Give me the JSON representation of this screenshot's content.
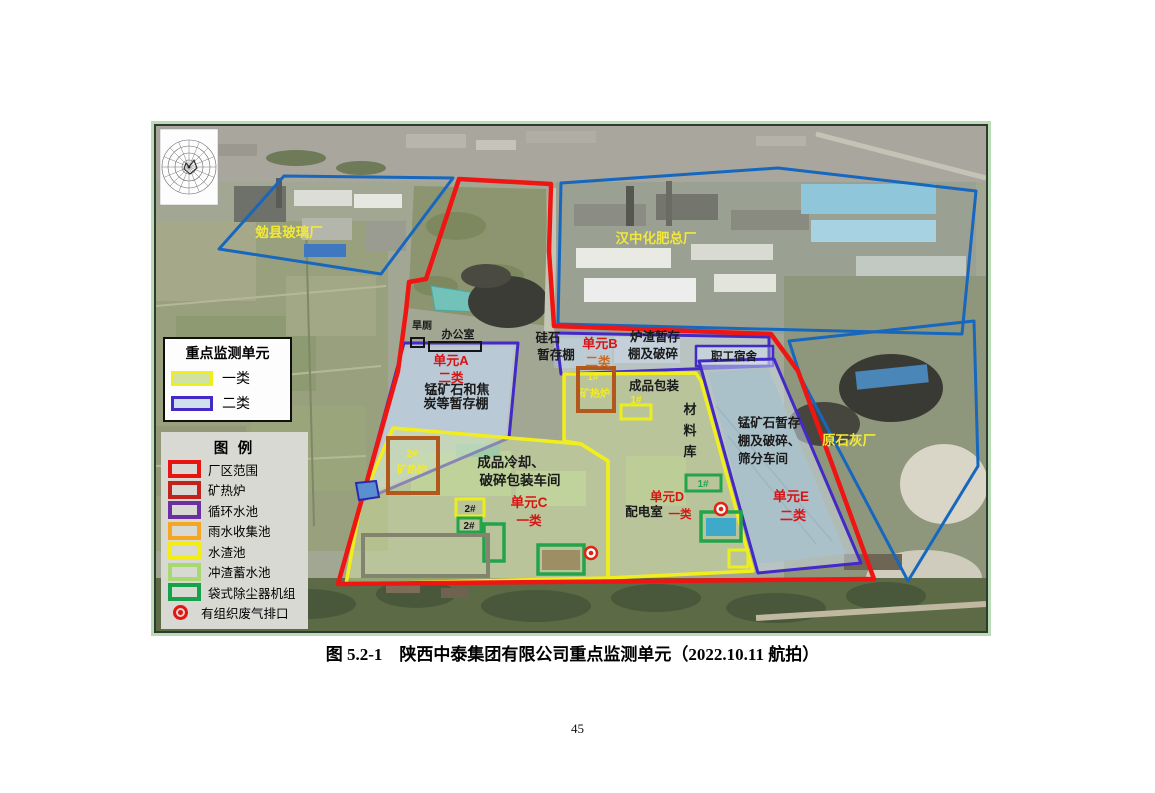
{
  "page": {
    "number": "45"
  },
  "figure_caption": "图 5.2-1　陕西中泰集团有限公司重点监测单元（2022.10.11 航拍）",
  "monitor_legend": {
    "title": "重点监测单元",
    "items": [
      {
        "label": "一类",
        "fill": "#cfe2a0",
        "border": "#f2ee1d"
      },
      {
        "label": "二类",
        "fill": "#cfdfee",
        "border": "#4329c6"
      }
    ]
  },
  "map_legend": {
    "title": "图 例",
    "items": [
      {
        "label": "厂区范围",
        "color": "#e6150f"
      },
      {
        "label": "矿热炉",
        "color": "#c2221c"
      },
      {
        "label": "循环水池",
        "color": "#6b2fa2"
      },
      {
        "label": "雨水收集池",
        "color": "#f5a623"
      },
      {
        "label": "水渣池",
        "color": "#f3ec15"
      },
      {
        "label": "冲渣蓄水池",
        "color": "#a7d96e"
      },
      {
        "label": "袋式除尘器机组",
        "color": "#16a14b"
      },
      {
        "label": "有组织废气排口",
        "color": "#e6150f"
      }
    ]
  },
  "photo_labels": {
    "glass_factory": "勉县玻璃厂",
    "fertilizer_factory": "汉中化肥总厂",
    "lime_factory": "原石灰厂",
    "dry_toilet": "旱厕",
    "office": "办公室",
    "unit_a": "单元A",
    "unit_a_class": "二类",
    "shed_a_line1": "锰矿石和焦",
    "shed_a_line2": "炭等暂存棚",
    "silica_line1": "硅石",
    "silica_line2": "暂存棚",
    "unit_b": "单元B",
    "unit_b_class": "二类",
    "slag_line1": "炉渣暂存",
    "slag_line2": "棚及破碎",
    "dorm": "职工宿舍",
    "furnace1_no": "1#",
    "furnace1_name": "矿热炉",
    "packing": "成品包装",
    "slag_pool1_no": "1#",
    "material_char1": "材",
    "material_char2": "料",
    "material_char3": "库",
    "mn_line1": "锰矿石暂存",
    "mn_line2": "棚及破碎、",
    "mn_line3": "筛分车间",
    "unit_e": "单元E",
    "unit_e_class": "二类",
    "furnace2_no": "2#",
    "furnace2_name": "矿热炉",
    "cooling_line1": "成品冷却、",
    "cooling_line2": "破碎包装车间",
    "unit_c": "单元C",
    "unit_c_class": "一类",
    "slag_pool2_no": "2#",
    "bag2_no": "2#",
    "unit_d": "单元D",
    "unit_d_class": "一类",
    "power_room": "配电室",
    "bag1_no": "1#"
  },
  "colors": {
    "boundary_red": "#ee1512",
    "neighbor_blue": "#1667bd",
    "class2_purple": "#4329c6",
    "class2_fill": "#cfdfee",
    "class1_yellow": "#f2ee1d",
    "class1_fill": "#cfe2a0",
    "furnace_brown": "#b3581d",
    "bagfilter_green": "#23a34a",
    "slagpool_yellow": "#eaee1e",
    "reservoir_gray": "#82846f",
    "exhaust_red": "#e02313",
    "unit_label_red": "#d81414",
    "unit_label_orange": "#cf6b1d",
    "factory_label_yellow": "#f2e838",
    "black_label": "#1a1a1a",
    "furnace_label_yellow": "#f3ea28"
  }
}
